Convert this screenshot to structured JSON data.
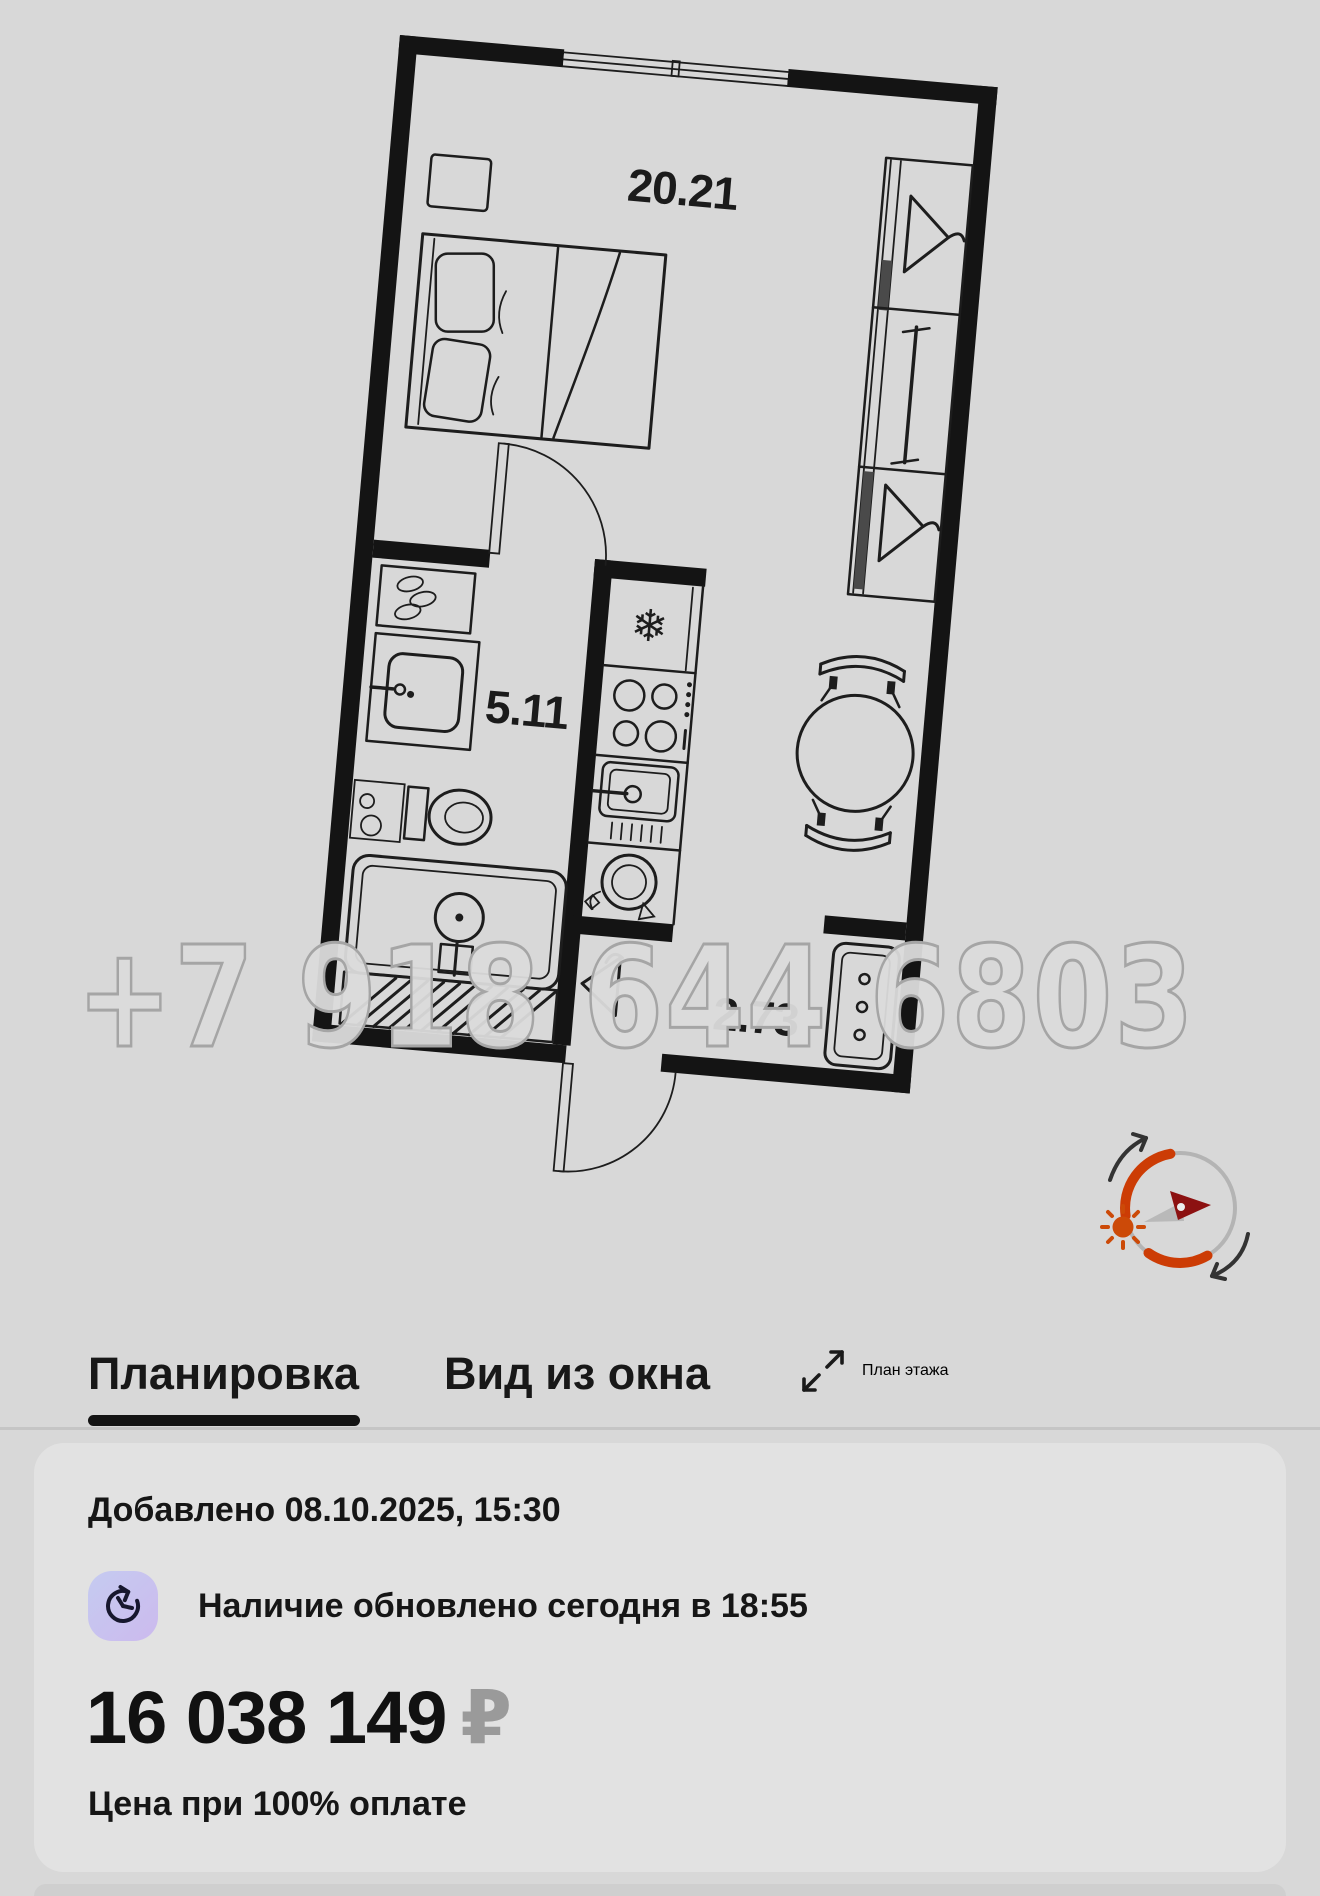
{
  "floor_plan": {
    "watermark": "+7 918 644 6803",
    "rooms": [
      {
        "id": "living-room",
        "area": "20.21"
      },
      {
        "id": "bathroom",
        "area": "5.11"
      },
      {
        "id": "hallway",
        "area": "2.73"
      }
    ],
    "compass": {
      "ring_color": "#b4b4b4",
      "accent_color": "#cc3c05",
      "sun_color": "#cc4a08",
      "needle_north_color": "#8c1111",
      "needle_south_color": "#b9b9b9"
    }
  },
  "tabs": {
    "items": [
      {
        "label": "Планировка",
        "active": true
      },
      {
        "label": "Вид из окна",
        "active": false
      },
      {
        "label": "План этажа",
        "active": false
      }
    ]
  },
  "listing": {
    "added": "Добавлено 08.10.2025, 15:30",
    "availability": "Наличие обновлено сегодня в 18:55",
    "price": "16 038 149",
    "currency": "₽",
    "price_note": "Цена при 100% оплате"
  },
  "colors": {
    "page_bg": "#d8d8d8",
    "card_bg": "#e2e2e2",
    "text": "#161616",
    "plan_line": "#1d1d1d",
    "muted": "#9a9a9a"
  }
}
